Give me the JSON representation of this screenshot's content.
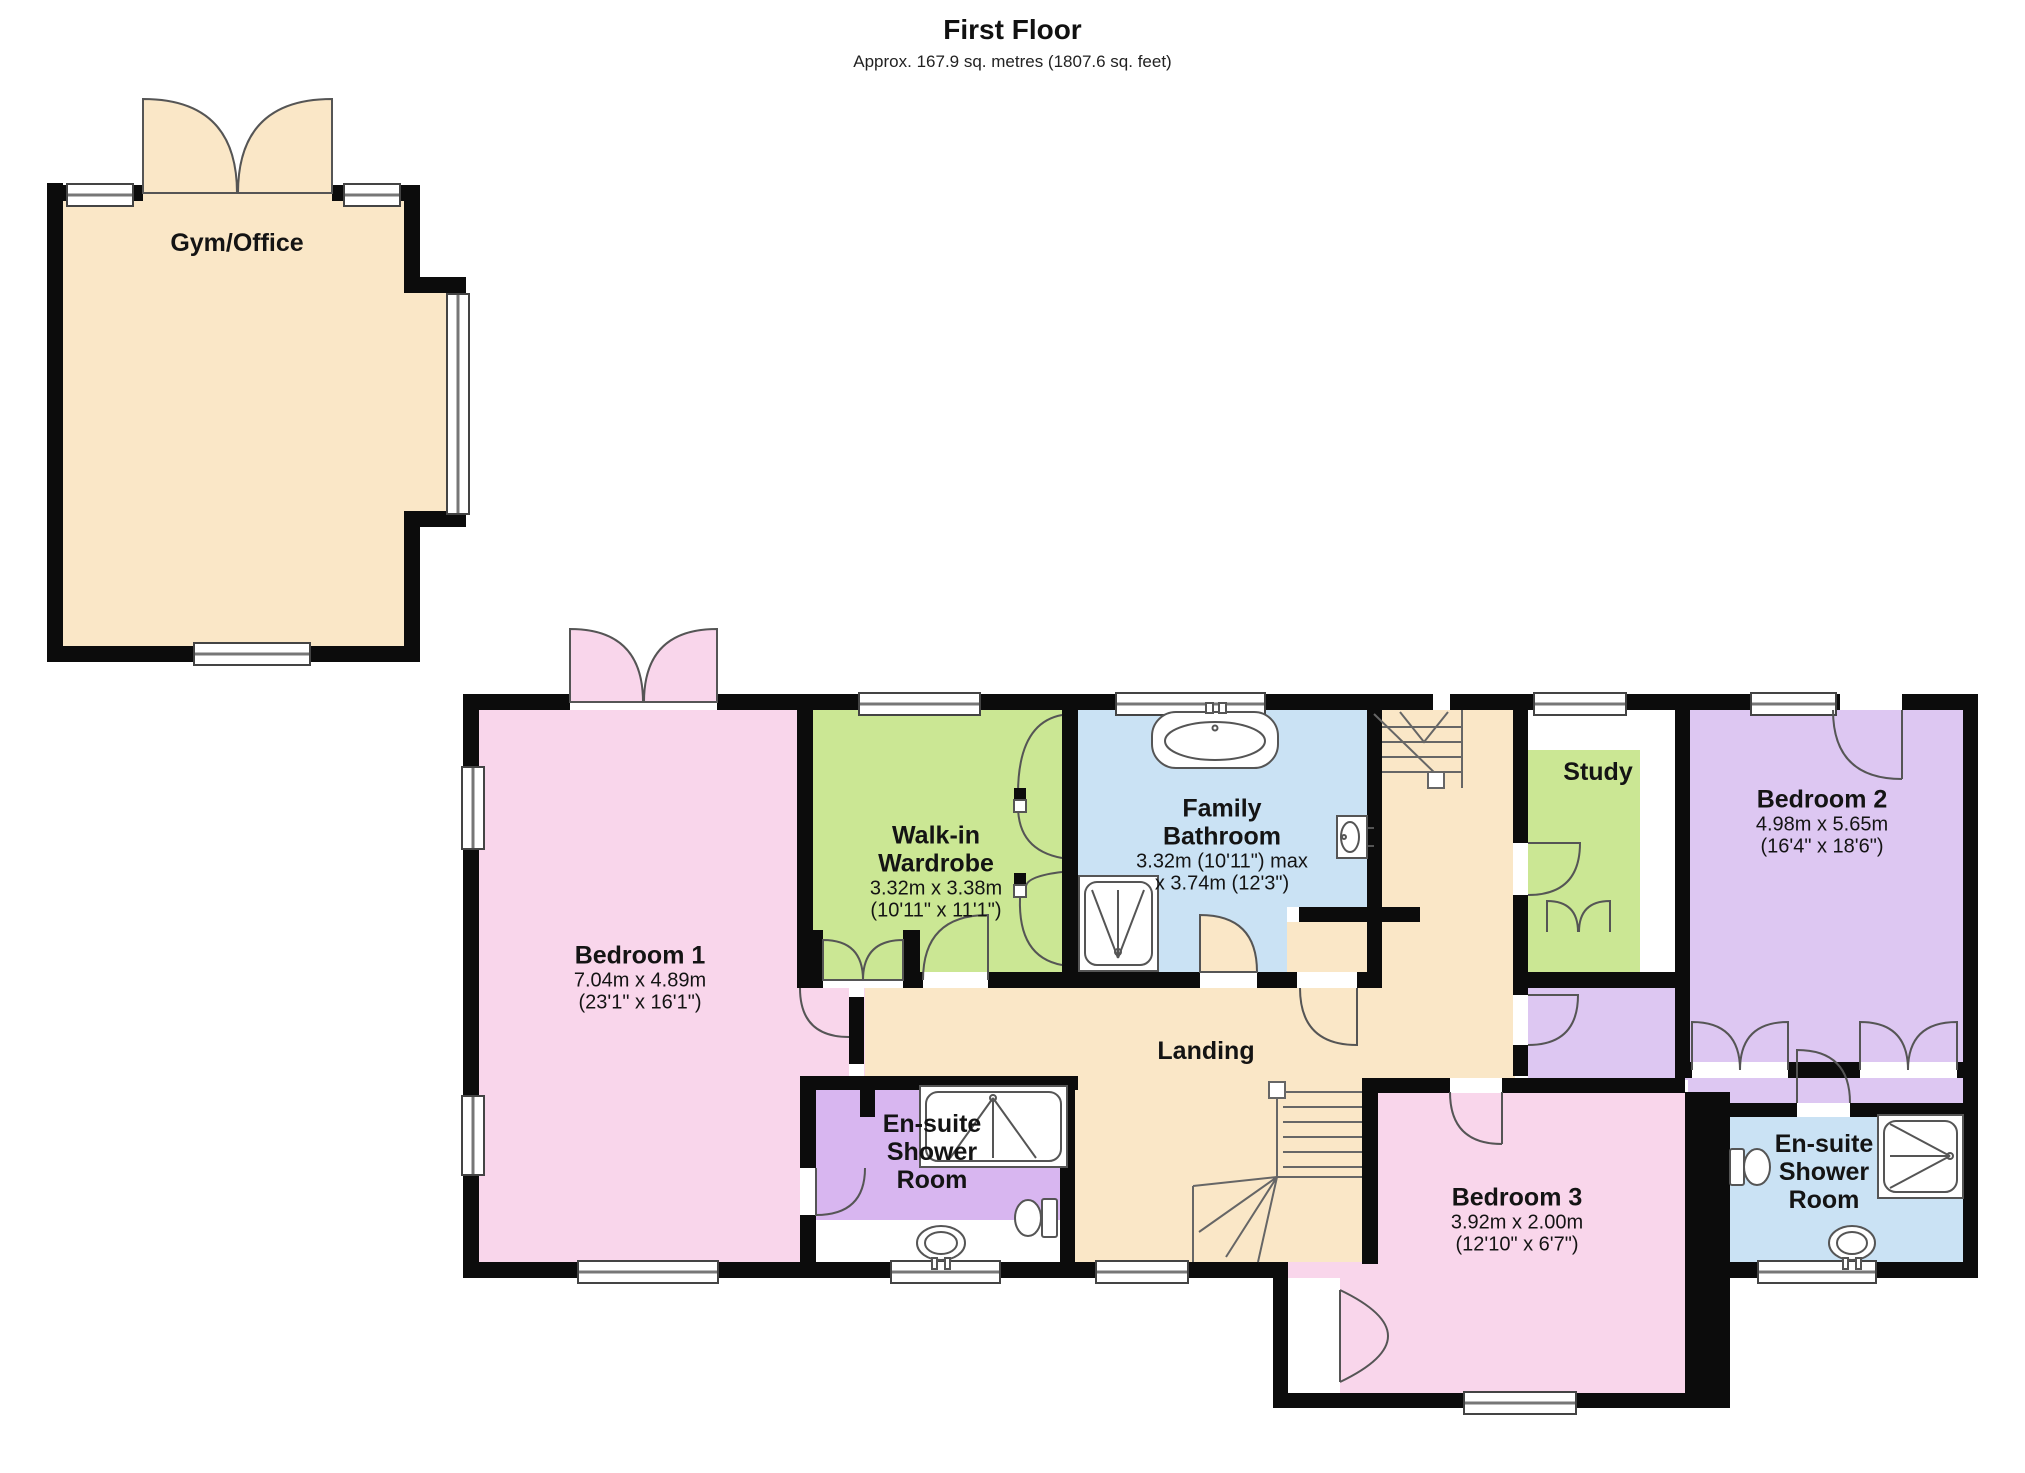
{
  "title": "First Floor",
  "subtitle": "Approx. 167.9 sq. metres (1807.6 sq. feet)",
  "colors": {
    "wall": "#0c0c0c",
    "floor_beige": "#FAE7C7",
    "pink": "#F9D6EB",
    "green": "#CBE794",
    "blue": "#CAE2F4",
    "purple": "#DDC7F2",
    "purple_deep": "#D8B6F0"
  },
  "rooms": {
    "gym_office": {
      "name": "Gym/Office"
    },
    "bedroom_1": {
      "name": "Bedroom 1",
      "metric": "7.04m x 4.89m",
      "imperial": "(23'1\" x 16'1\")"
    },
    "walk_in_wardrobe": {
      "name": "Walk-in Wardrobe",
      "metric": "3.32m x 3.38m",
      "imperial": "(10'11\" x 11'1\")"
    },
    "family_bathroom": {
      "name": "Family Bathroom",
      "metric": "3.32m (10'11\") max",
      "imperial": "x 3.74m (12'3\")"
    },
    "study": {
      "name": "Study"
    },
    "bedroom_2": {
      "name": "Bedroom 2",
      "metric": "4.98m x 5.65m",
      "imperial": "(16'4\" x 18'6\")"
    },
    "landing": {
      "name": "Landing"
    },
    "ensuite_1": {
      "name": "En-suite Shower Room"
    },
    "bedroom_3": {
      "name": "Bedroom 3",
      "metric": "3.92m x 2.00m",
      "imperial": "(12'10\" x 6'7\")"
    },
    "ensuite_2": {
      "name": "En-suite Shower Room"
    }
  }
}
